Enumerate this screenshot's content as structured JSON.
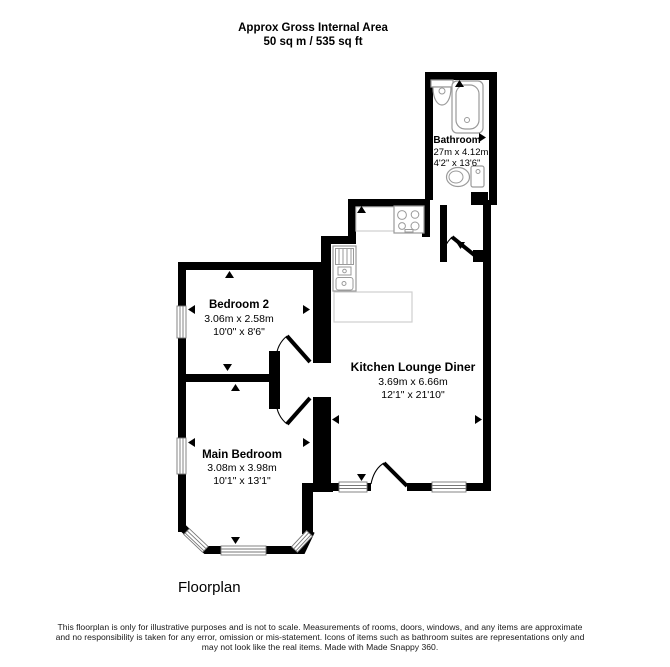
{
  "title": {
    "line1": "Approx Gross Internal Area",
    "line2": "50 sq m / 535 sq ft"
  },
  "rooms": {
    "bathroom": {
      "name": "Bathroom",
      "metric": "1.27m x 4.12m",
      "imperial": "4'2\" x 13'6\""
    },
    "bedroom2": {
      "name": "Bedroom 2",
      "metric": "3.06m x 2.58m",
      "imperial": "10'0\" x 8'6\""
    },
    "kitchen_lounge_diner": {
      "name": "Kitchen Lounge Diner",
      "metric": "3.69m x 6.66m",
      "imperial": "12'1\" x 21'10\""
    },
    "main_bedroom": {
      "name": "Main Bedroom",
      "metric": "3.08m x 3.98m",
      "imperial": "10'1\" x 13'1\""
    }
  },
  "caption": "Floorplan",
  "disclaimer": {
    "line1": "This floorplan is only for illustrative purposes and is not to scale. Measurements of rooms, doors, windows, and any items are approximate",
    "line2": "and no responsibility is taken for any error, omission or mis-statement. Icons of items such as bathroom suites are representations only and",
    "line3": "may not look like the real items. Made with Made Snappy 360."
  },
  "colors": {
    "wall": "#000000",
    "background": "#ffffff",
    "fixture_outline": "#9a9a9a",
    "counter_outline": "#cfcfcf",
    "window_frame": "#777777",
    "text": "#000000"
  },
  "fixtures": [
    "wash-basin",
    "bathtub",
    "toilet",
    "hob",
    "kitchen-sink-unit",
    "worktop"
  ]
}
